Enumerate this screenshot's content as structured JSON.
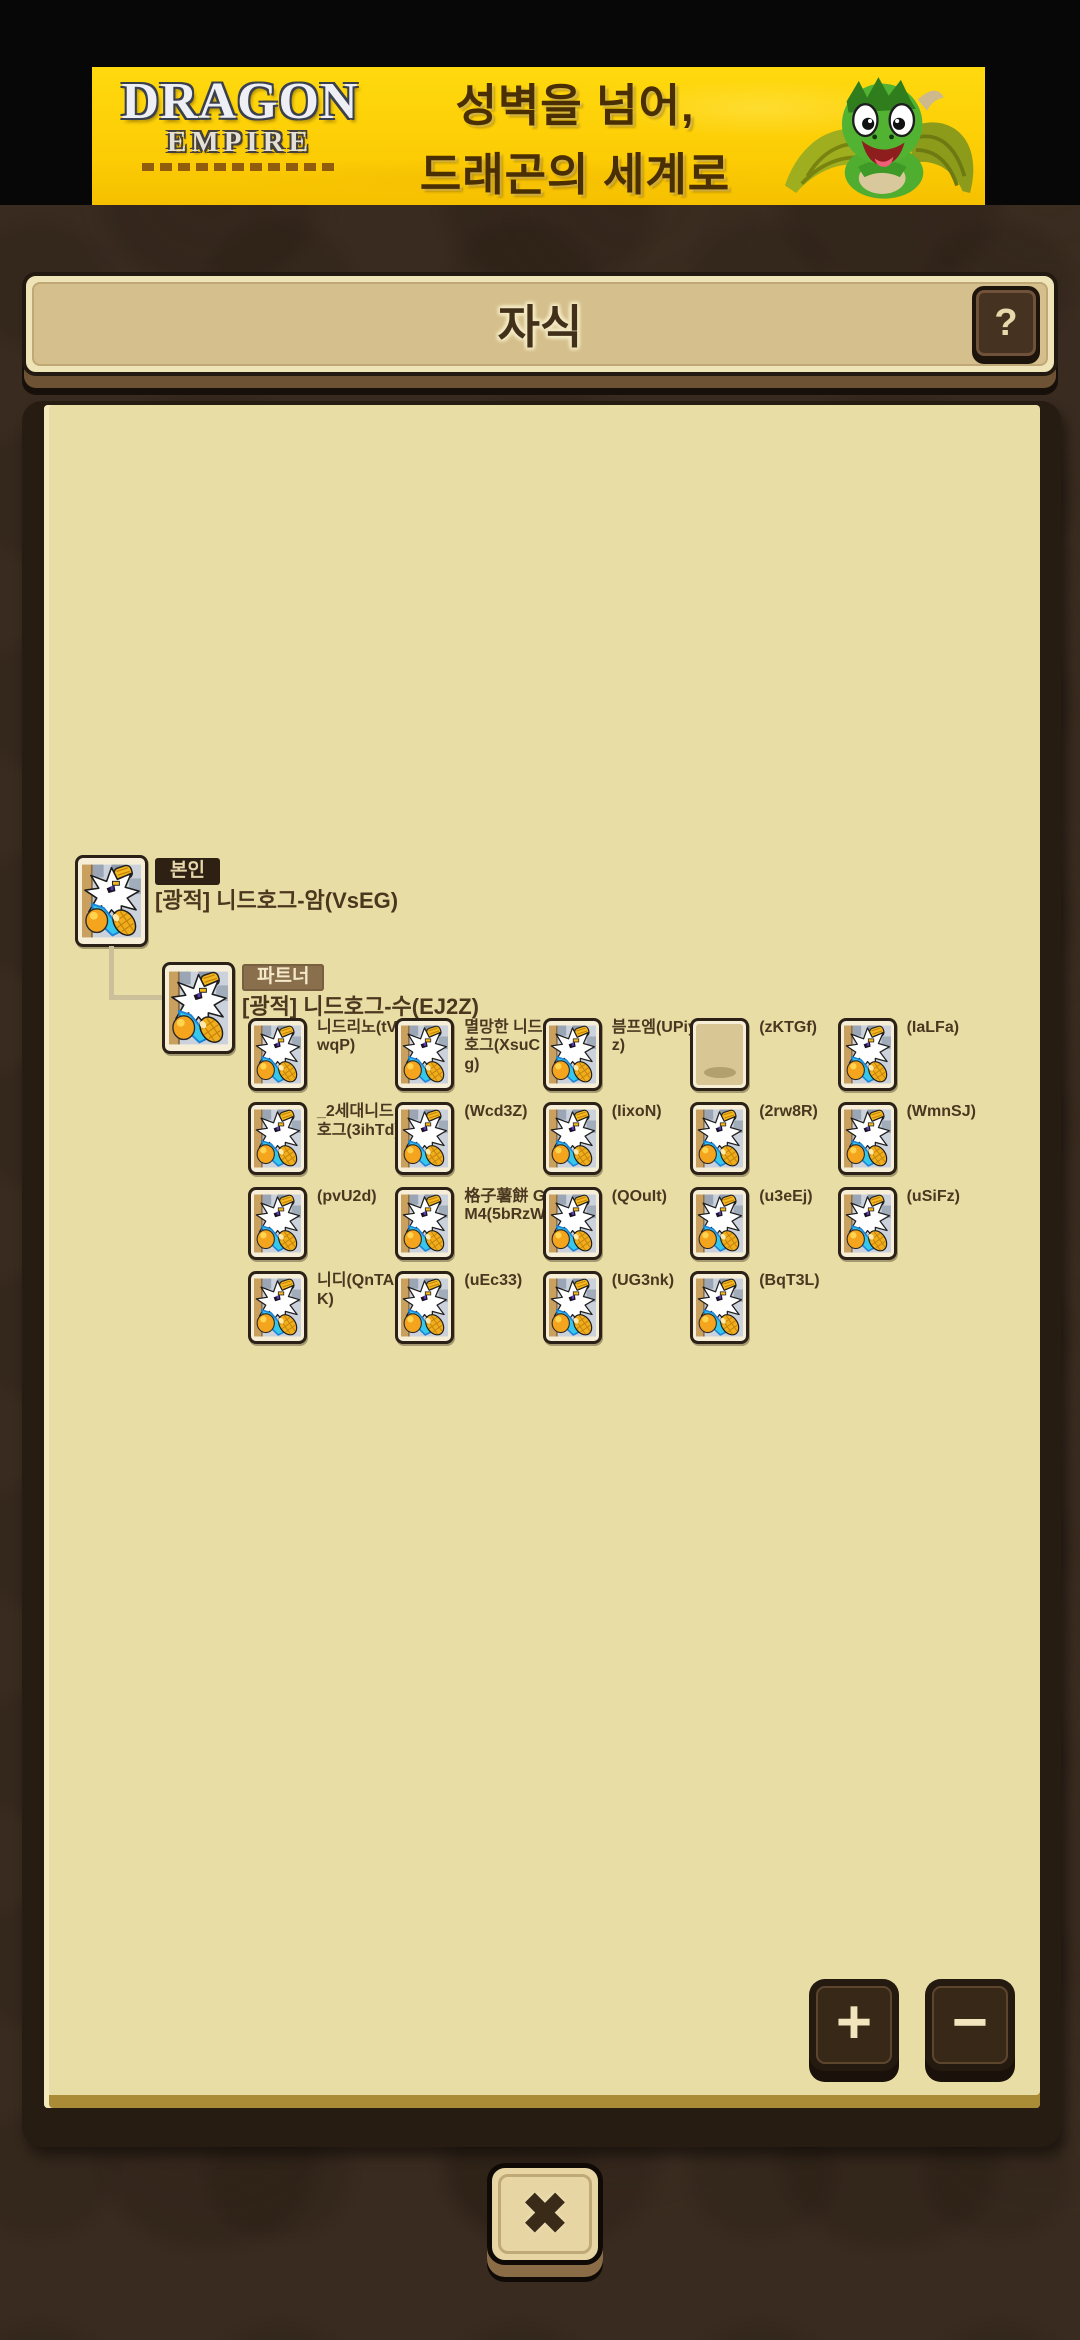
{
  "ad_banner": {
    "logo_line1": "DRAGON",
    "logo_line2": "EMPIRE",
    "headline_line1": "성벽을 넘어,",
    "headline_line2": "드래곤의 세계로"
  },
  "header": {
    "title": "자식"
  },
  "controls": {
    "help_label": "?",
    "zoom_in_label": "+",
    "zoom_out_label": "−",
    "close_label": "✖"
  },
  "tree": {
    "self": {
      "badge": "본인",
      "name": "[광적] 니드호그-암(VsEG)"
    },
    "partner": {
      "badge": "파트너",
      "name": "[광적] 니드호그-수(EJ2Z)"
    },
    "children": [
      {
        "name": "니드리노(tVwqP)",
        "empty": false
      },
      {
        "name": "멸망한 니드호그(XsuCg)",
        "empty": false
      },
      {
        "name": "븜프엠(UPiyz)",
        "empty": false
      },
      {
        "name": "(zKTGf)",
        "empty": true
      },
      {
        "name": "(IaLFa)",
        "empty": false
      },
      {
        "name": "_2세대니드호그(3ihTd)",
        "empty": false
      },
      {
        "name": "(Wcd3Z)",
        "empty": false
      },
      {
        "name": "(IixoN)",
        "empty": false
      },
      {
        "name": "(2rw8R)",
        "empty": false
      },
      {
        "name": "(WmnSJ)",
        "empty": false
      },
      {
        "name": "(pvU2d)",
        "empty": false
      },
      {
        "name": "格子薯餅 G2M4(5bRzW)",
        "empty": false
      },
      {
        "name": "(QOuIt)",
        "empty": false
      },
      {
        "name": "(u3eEj)",
        "empty": false
      },
      {
        "name": "(uSiFz)",
        "empty": false
      },
      {
        "name": "니디(QnTAK)",
        "empty": false
      },
      {
        "name": "(uEc33)",
        "empty": false
      },
      {
        "name": "(UG3nk)",
        "empty": false
      },
      {
        "name": "(BqT3L)",
        "empty": false
      }
    ]
  },
  "colors": {
    "background": "#392b1f",
    "banner_yellow": "#ffd90e",
    "panel_frame": "#271c12",
    "panel_paper": "#e9dda6",
    "titlebar_fill": "#d5bf8c",
    "badge_self_bg": "#2e2012",
    "badge_partner_bg": "#8a6f4c",
    "text_brown": "#4b361e",
    "torn_edge_gold": "#aa8b36"
  }
}
